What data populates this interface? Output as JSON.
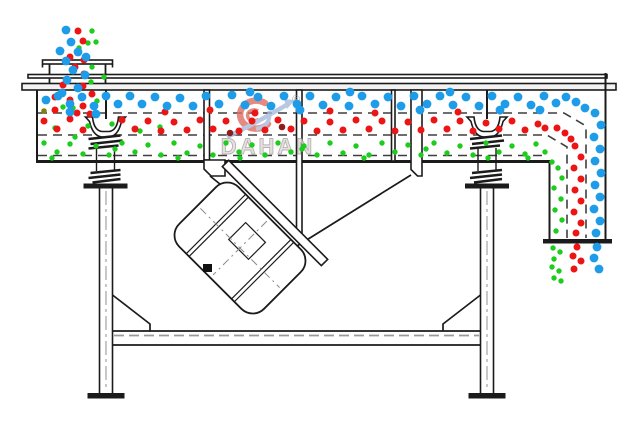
{
  "watermark": {
    "brand": "DAHAN",
    "registered": "®"
  },
  "colors": {
    "particle_blue": "#1e9ce8",
    "particle_red": "#ec1515",
    "particle_green": "#1ecc1e",
    "particle_dark_red": "#8b1f1f",
    "particle_olive": "#7f7f10",
    "line": "#1b1b1b",
    "screen_dash": "#3f3f3f",
    "frame_dash": "#9a9a9a",
    "watermark_red": "#df6e62",
    "watermark_blue": "#a7badc",
    "watermark_text": "#dedad9"
  },
  "particles": {
    "green": {
      "r": 2.7,
      "color_key": "particle_green",
      "points": [
        [
          92,
          31
        ],
        [
          88,
          43
        ],
        [
          96,
          42
        ],
        [
          79,
          48
        ],
        [
          92,
          67
        ],
        [
          104,
          77
        ],
        [
          91,
          82
        ],
        [
          63,
          107
        ],
        [
          73,
          108
        ],
        [
          97,
          101
        ],
        [
          55,
          128
        ],
        [
          88,
          126
        ],
        [
          112,
          124
        ],
        [
          140,
          131
        ],
        [
          160,
          127
        ],
        [
          75,
          137
        ],
        [
          44,
          143
        ],
        [
          57,
          152
        ],
        [
          70,
          144
        ],
        [
          83,
          154
        ],
        [
          96,
          146
        ],
        [
          109,
          155
        ],
        [
          122,
          143
        ],
        [
          135,
          152
        ],
        [
          148,
          145
        ],
        [
          161,
          155
        ],
        [
          174,
          143
        ],
        [
          187,
          153
        ],
        [
          200,
          146
        ],
        [
          213,
          155
        ],
        [
          226,
          143
        ],
        [
          239,
          152
        ],
        [
          252,
          145
        ],
        [
          265,
          155
        ],
        [
          278,
          143
        ],
        [
          291,
          152
        ],
        [
          304,
          146
        ],
        [
          317,
          155
        ],
        [
          330,
          143
        ],
        [
          343,
          153
        ],
        [
          356,
          146
        ],
        [
          369,
          155
        ],
        [
          382,
          143
        ],
        [
          395,
          152
        ],
        [
          408,
          145
        ],
        [
          421,
          155
        ],
        [
          434,
          143
        ],
        [
          447,
          153
        ],
        [
          460,
          146
        ],
        [
          473,
          155
        ],
        [
          486,
          143
        ],
        [
          499,
          152
        ],
        [
          512,
          146
        ],
        [
          525,
          154
        ],
        [
          536,
          144
        ],
        [
          545,
          152
        ],
        [
          52,
          158
        ],
        [
          115,
          149
        ],
        [
          178,
          158
        ],
        [
          240,
          158
        ],
        [
          302,
          149
        ],
        [
          364,
          158
        ],
        [
          426,
          149
        ],
        [
          488,
          158
        ],
        [
          528,
          158
        ],
        [
          552,
          162
        ],
        [
          558,
          168
        ],
        [
          562,
          178
        ],
        [
          554,
          188
        ],
        [
          561,
          199
        ],
        [
          555,
          210
        ],
        [
          562,
          220
        ],
        [
          556,
          231
        ],
        [
          553,
          248
        ],
        [
          560,
          252
        ],
        [
          554,
          259
        ],
        [
          552,
          267
        ],
        [
          559,
          271
        ],
        [
          554,
          278
        ],
        [
          561,
          281
        ]
      ]
    },
    "red": {
      "r": 3.5,
      "color_key": "particle_red",
      "points": [
        [
          78,
          31
        ],
        [
          83,
          41
        ],
        [
          70,
          57
        ],
        [
          84,
          60
        ],
        [
          75,
          67
        ],
        [
          84,
          74
        ],
        [
          63,
          85
        ],
        [
          83,
          86
        ],
        [
          92,
          94
        ],
        [
          55,
          97
        ],
        [
          70,
          100
        ],
        [
          83,
          106
        ],
        [
          55,
          110
        ],
        [
          77,
          113
        ],
        [
          44,
          121
        ],
        [
          57,
          129
        ],
        [
          70,
          119
        ],
        [
          83,
          130
        ],
        [
          90,
          114
        ],
        [
          122,
          120
        ],
        [
          135,
          129
        ],
        [
          148,
          121
        ],
        [
          161,
          131
        ],
        [
          174,
          122
        ],
        [
          187,
          130
        ],
        [
          200,
          120
        ],
        [
          213,
          129
        ],
        [
          226,
          121
        ],
        [
          239,
          131
        ],
        [
          252,
          121
        ],
        [
          265,
          130
        ],
        [
          278,
          120
        ],
        [
          291,
          129
        ],
        [
          304,
          121
        ],
        [
          317,
          131
        ],
        [
          330,
          122
        ],
        [
          343,
          130
        ],
        [
          356,
          120
        ],
        [
          369,
          129
        ],
        [
          382,
          121
        ],
        [
          395,
          131
        ],
        [
          408,
          122
        ],
        [
          421,
          130
        ],
        [
          434,
          120
        ],
        [
          447,
          129
        ],
        [
          460,
          121
        ],
        [
          473,
          131
        ],
        [
          486,
          123
        ],
        [
          499,
          129
        ],
        [
          512,
          121
        ],
        [
          525,
          130
        ],
        [
          538,
          124
        ],
        [
          545,
          128
        ],
        [
          165,
          112
        ],
        [
          210,
          110
        ],
        [
          255,
          113
        ],
        [
          330,
          111
        ],
        [
          375,
          113
        ],
        [
          420,
          110
        ],
        [
          458,
          112
        ],
        [
          500,
          111
        ],
        [
          557,
          128
        ],
        [
          565,
          133
        ],
        [
          571,
          139
        ],
        [
          575,
          146
        ],
        [
          581,
          157
        ],
        [
          574,
          168
        ],
        [
          581,
          179
        ],
        [
          575,
          190
        ],
        [
          581,
          201
        ],
        [
          574,
          212
        ],
        [
          581,
          223
        ],
        [
          576,
          233
        ],
        [
          577,
          247
        ],
        [
          573,
          256
        ],
        [
          581,
          261
        ],
        [
          574,
          269
        ]
      ]
    },
    "dark_red": {
      "r": 3.3,
      "color_key": "particle_dark_red",
      "points": [
        [
          282,
          127
        ],
        [
          230,
          133
        ]
      ]
    },
    "olive": {
      "r": 2.8,
      "color_key": "particle_olive",
      "points": [
        [
          44,
          111
        ]
      ]
    },
    "blue": {
      "r": 4.4,
      "color_key": "particle_blue",
      "points": [
        [
          66,
          30
        ],
        [
          71,
          42
        ],
        [
          60,
          51
        ],
        [
          78,
          52
        ],
        [
          86,
          57
        ],
        [
          66,
          61
        ],
        [
          73,
          70
        ],
        [
          85,
          75
        ],
        [
          67,
          80
        ],
        [
          78,
          88
        ],
        [
          62,
          93
        ],
        [
          46,
          100
        ],
        [
          58,
          96
        ],
        [
          70,
          104
        ],
        [
          82,
          97
        ],
        [
          94,
          106
        ],
        [
          106,
          96
        ],
        [
          118,
          104
        ],
        [
          130,
          96
        ],
        [
          142,
          104
        ],
        [
          70,
          112
        ],
        [
          96,
          114
        ],
        [
          155,
          97
        ],
        [
          167,
          106
        ],
        [
          180,
          98
        ],
        [
          193,
          106
        ],
        [
          206,
          96
        ],
        [
          219,
          104
        ],
        [
          232,
          95
        ],
        [
          245,
          105
        ],
        [
          250,
          92
        ],
        [
          258,
          97
        ],
        [
          271,
          106
        ],
        [
          284,
          96
        ],
        [
          297,
          104
        ],
        [
          310,
          96
        ],
        [
          323,
          105
        ],
        [
          336,
          97
        ],
        [
          349,
          106
        ],
        [
          350,
          92
        ],
        [
          362,
          96
        ],
        [
          375,
          104
        ],
        [
          388,
          97
        ],
        [
          401,
          106
        ],
        [
          414,
          96
        ],
        [
          427,
          104
        ],
        [
          440,
          96
        ],
        [
          450,
          92
        ],
        [
          453,
          105
        ],
        [
          466,
          97
        ],
        [
          479,
          106
        ],
        [
          492,
          96
        ],
        [
          505,
          104
        ],
        [
          518,
          97
        ],
        [
          531,
          105
        ],
        [
          544,
          96
        ],
        [
          300,
          110
        ],
        [
          420,
          110
        ],
        [
          500,
          110
        ],
        [
          540,
          110
        ],
        [
          556,
          103
        ],
        [
          566,
          97
        ],
        [
          576,
          102
        ],
        [
          585,
          108
        ],
        [
          595,
          113
        ],
        [
          601,
          125
        ],
        [
          594,
          137
        ],
        [
          600,
          149
        ],
        [
          595,
          161
        ],
        [
          601,
          173
        ],
        [
          595,
          185
        ],
        [
          600,
          197
        ],
        [
          594,
          209
        ],
        [
          600,
          221
        ],
        [
          596,
          233
        ],
        [
          597,
          247
        ],
        [
          594,
          258
        ],
        [
          599,
          269
        ]
      ]
    }
  }
}
